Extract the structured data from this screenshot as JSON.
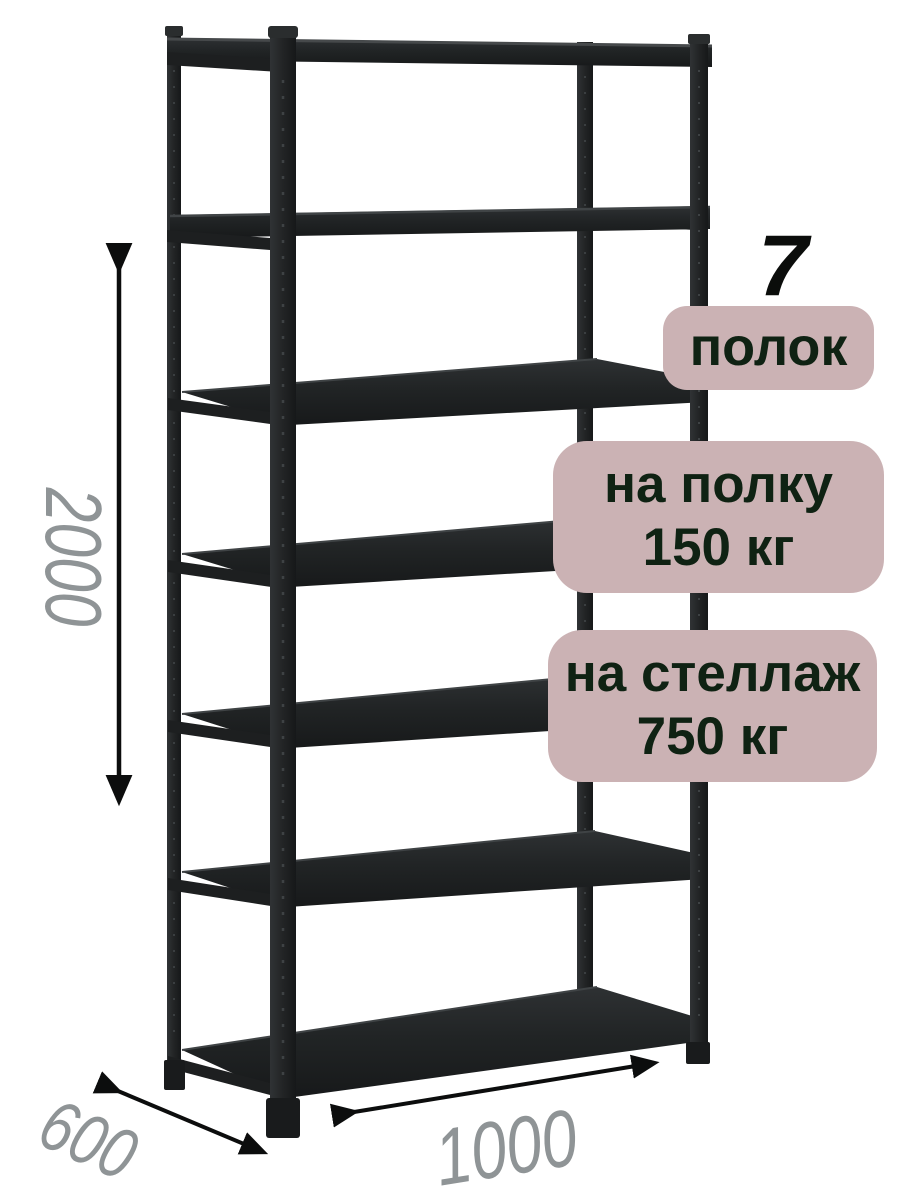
{
  "labels": {
    "shelf_count": "7",
    "shelf_count_unit": "полок",
    "per_shelf_line1": "на полку",
    "per_shelf_line2": "150 кг",
    "per_rack_line1": "на стеллаж",
    "per_rack_line2": "750 кг"
  },
  "dimensions": {
    "height": "2000",
    "depth": "600",
    "width": "1000"
  },
  "illustration": {
    "type": "metal-shelving-rack",
    "shelf_count": 7,
    "color": "black"
  },
  "colors": {
    "background": "#ffffff",
    "badge_bg": "#cbb2b4",
    "badge_text": "#0f2213",
    "dimension_text": "#8f9496",
    "rack_dark": "#1e2021",
    "arrow": "#0c0d0d"
  }
}
